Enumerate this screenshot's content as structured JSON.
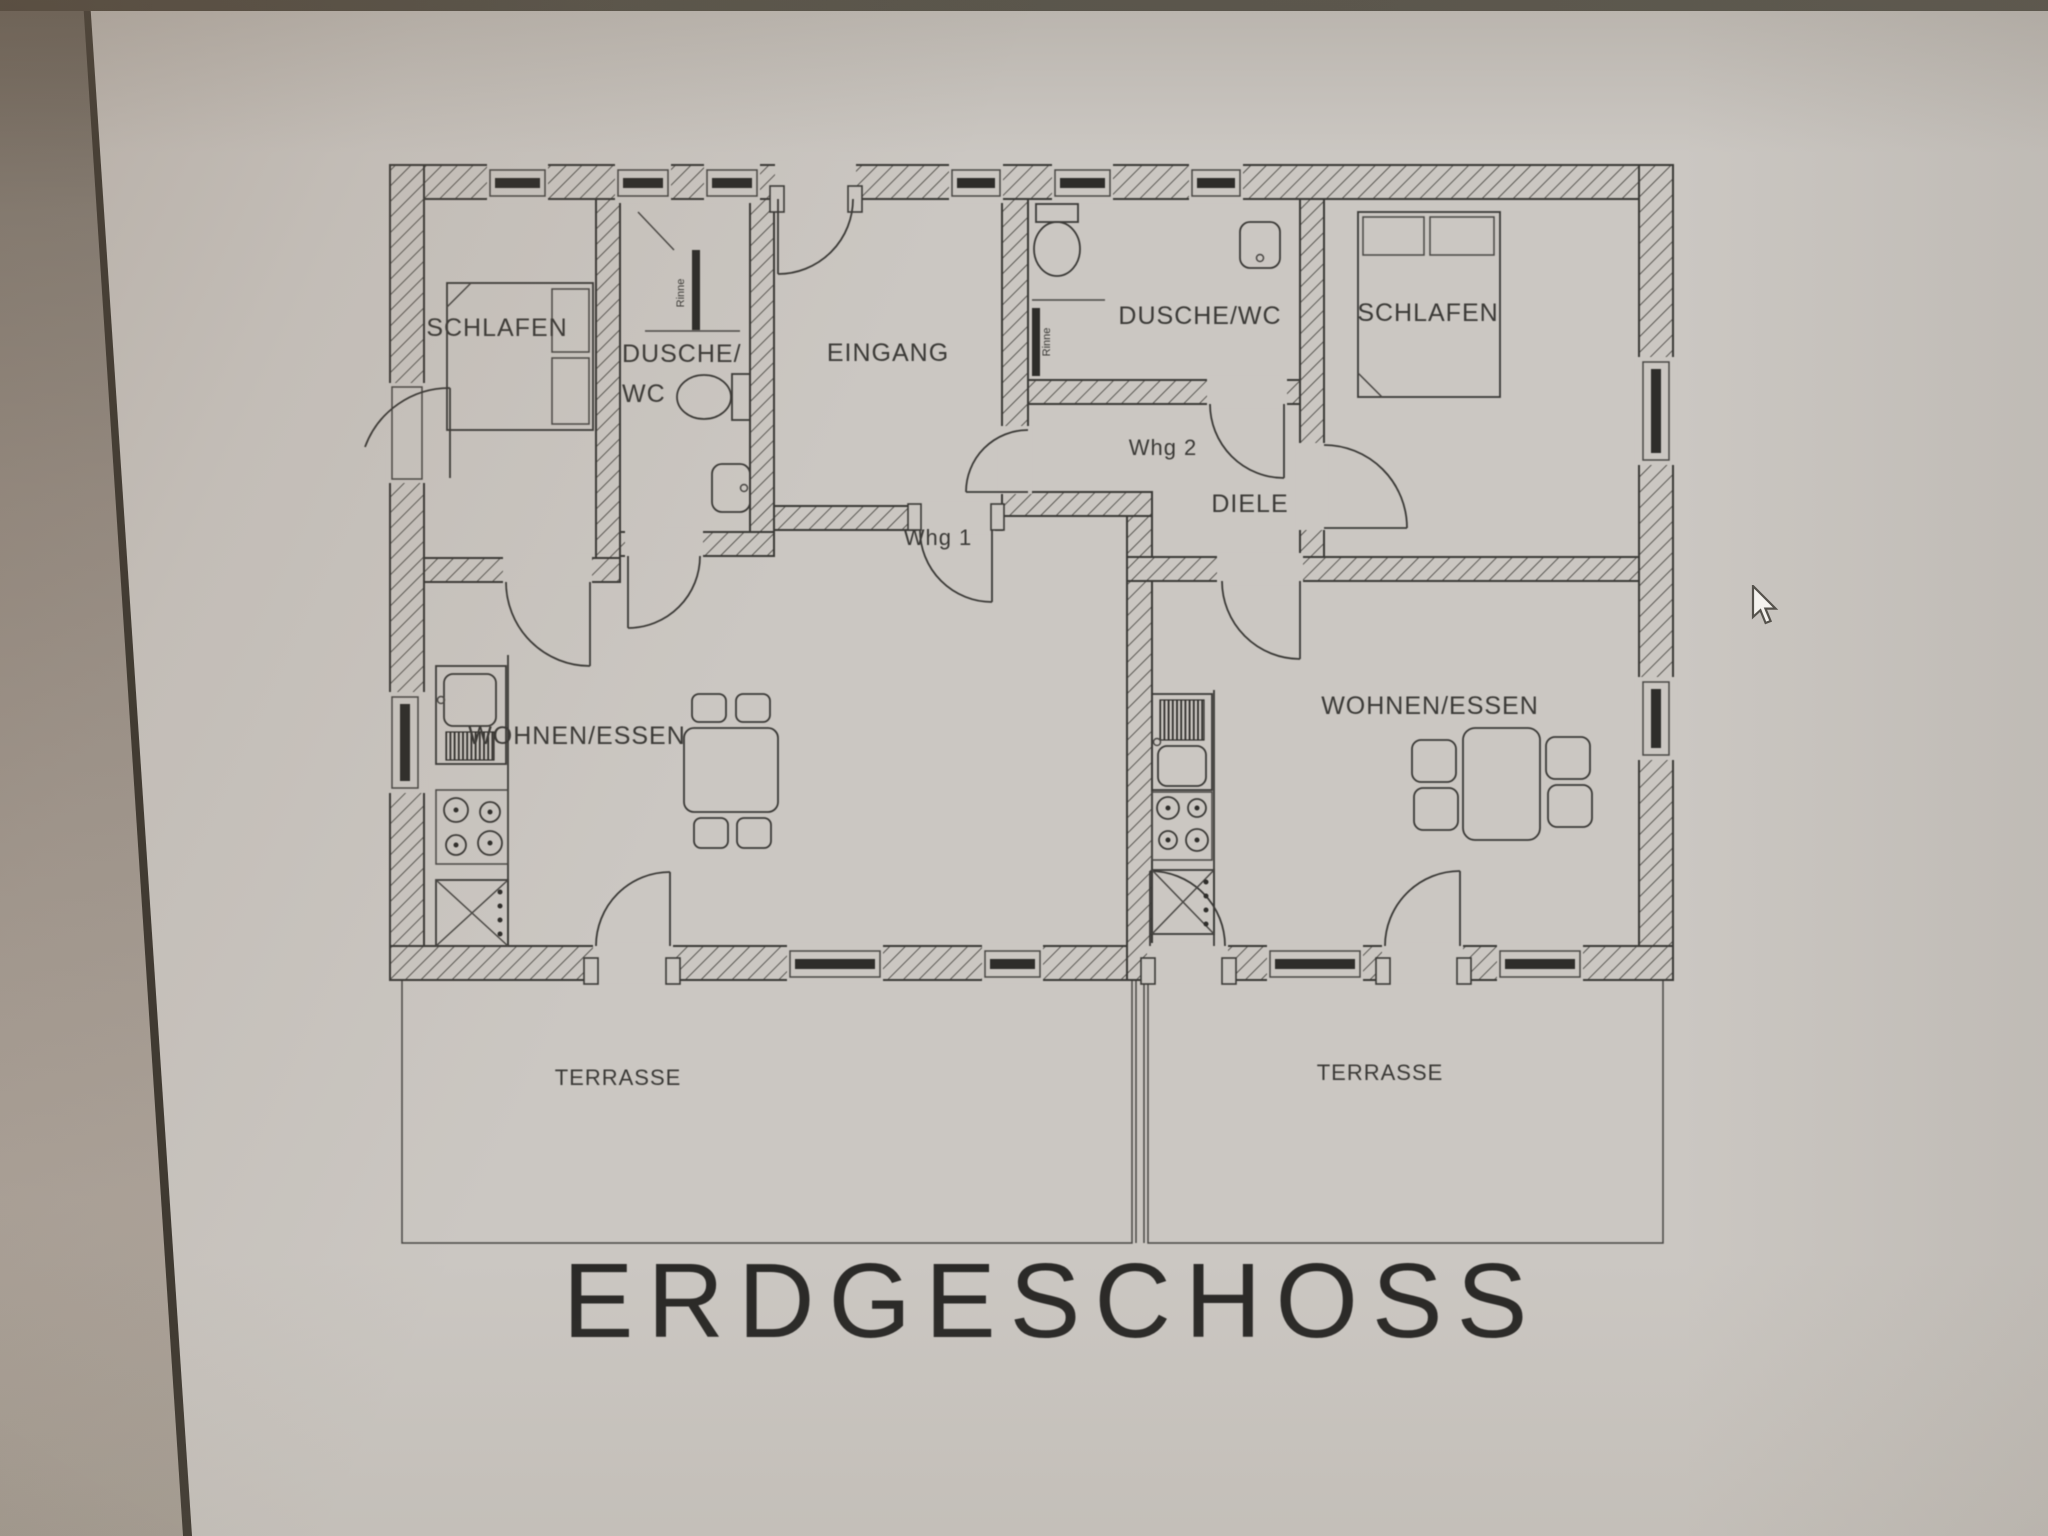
{
  "title": {
    "text": "ERDGESCHOSS"
  },
  "labels": {
    "apt1_bedroom": "SCHLAFEN",
    "apt1_bath_line1": "DUSCHE/",
    "apt1_bath_line2": "WC",
    "entrance": "EINGANG",
    "apt1_ref": "Whg 1",
    "apt2_ref": "Whg 2",
    "apt2_bath": "DUSCHE/WC",
    "apt2_bedroom": "SCHLAFEN",
    "apt2_hall": "DIELE",
    "apt1_living": "WOHNEN/ESSEN",
    "apt2_living": "WOHNEN/ESSEN",
    "apt1_terrace": "TERRASSE",
    "apt2_terrace": "TERRASSE",
    "drain_label_1": "Rinne",
    "drain_label_2": "Rinne"
  },
  "colors": {
    "paper": "#cbc7c2",
    "line": "#3b3a37",
    "window_bar": "#2e2d2a",
    "title_text": "#2a2927",
    "bezel_dark": "#6b645b",
    "bezel_light": "#ada49b",
    "top_bar": "#56534a"
  }
}
